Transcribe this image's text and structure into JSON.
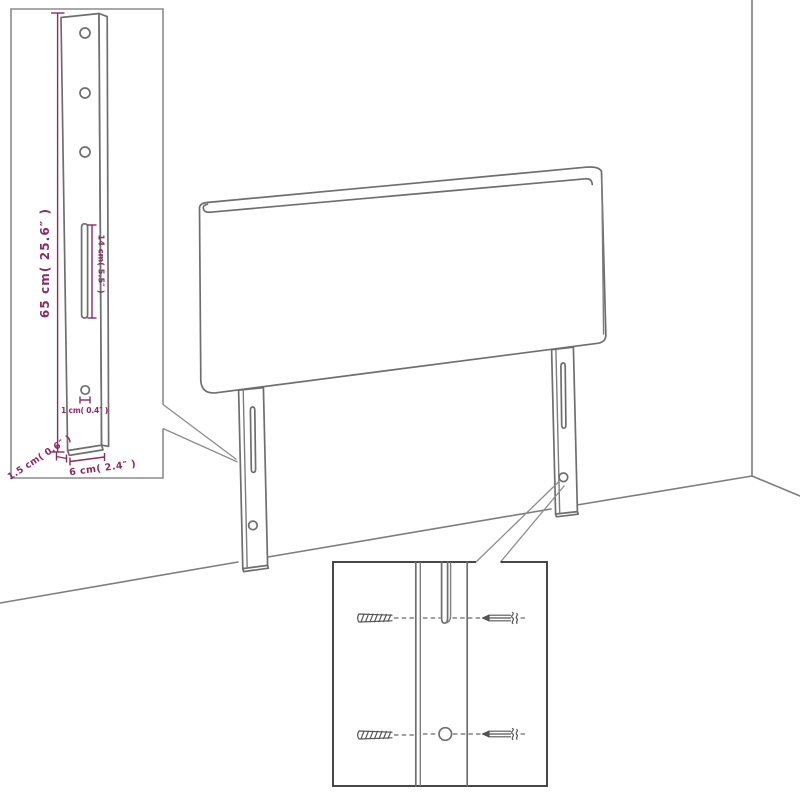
{
  "page": {
    "background": "#ffffff"
  },
  "diagram": {
    "description": "Upholstered headboard with two mounting legs standing against a wall corner; a leg dimension detail inset (top-left) and a screw mounting detail inset (bottom-center)",
    "colors": {
      "outline": "#6e6e6e",
      "wall_line": "#7d7d7d",
      "inset_border": "#8c8c8c",
      "detail_border": "#474747",
      "dimension": "#8a2b63",
      "background": "#ffffff"
    },
    "leg_dimension_inset": {
      "height_label": "65 cm( 25.6″ )",
      "slot_length_label": "14 cm( 5.5″ )",
      "hole_diameter_label": "1 cm( 0.4″ )",
      "thickness_label": "1.5 cm( 0.6″ )",
      "width_label": "6 cm( 2.4″ )"
    }
  }
}
